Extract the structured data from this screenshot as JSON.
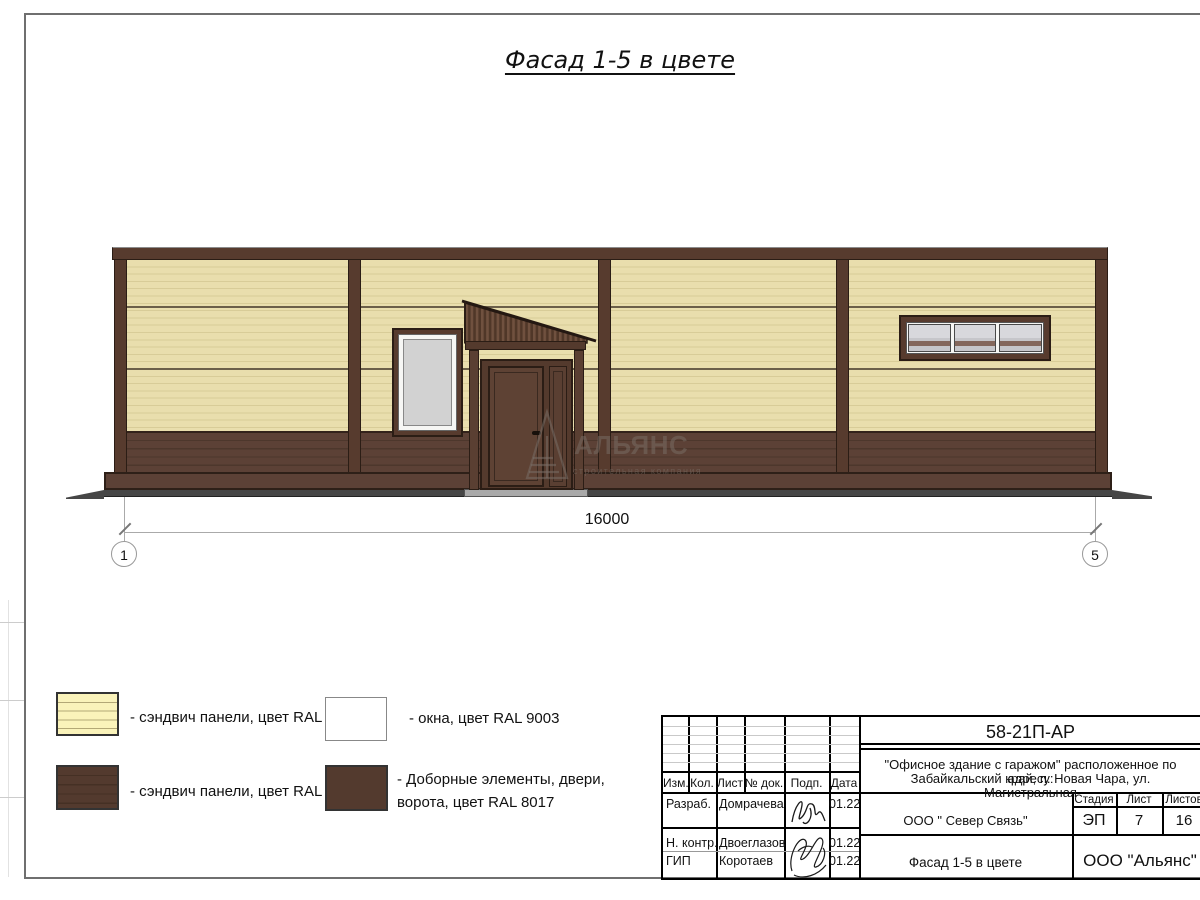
{
  "sheet": {
    "title": "Фасад 1-5 в цвете"
  },
  "dimension": {
    "total": "16000",
    "axis_start": "1",
    "axis_end": "5"
  },
  "watermark": {
    "name": "АЛЬЯНС",
    "tagline": "строительная компания"
  },
  "legend": {
    "sandwich_1014": "- сэндвич панели, цвет RAL 1014",
    "sandwich_8017": "- сэндвич панели, цвет RAL 8017",
    "windows_9003": "- окна, цвет RAL 9003",
    "doors_8017": "- Доборные элементы, двери,\nворота, цвет RAL 8017"
  },
  "title_block": {
    "doc_number": "58-21П-АР",
    "project_line1": "\"Офисное здание с гаражом\" расположенное по адресу:",
    "project_line2": "Забайкальский край, п. Новая Чара, ул. Магистральная",
    "col_izm": "Изм.",
    "col_kol": "Кол.",
    "col_list": "Лист",
    "col_doc": "№ док.",
    "col_podp": "Подп.",
    "col_data": "Дата",
    "rows": [
      {
        "role": "Разраб.",
        "name": "Домрачева",
        "date": "01.22"
      },
      {
        "role": "Н. контр.",
        "name": "Двоеглазов",
        "date": "01.22"
      },
      {
        "role": "ГИП",
        "name": "Коротаев",
        "date": "01.22"
      }
    ],
    "org": "ООО \" Север Связь\"",
    "stage_label": "Стадия",
    "sheet_label": "Лист",
    "sheets_label": "Листов",
    "stage": "ЭП",
    "sheet_num": "7",
    "sheets_total": "16",
    "drawing_name": "Фасад 1-5 в цвете",
    "company": "ООО \"Альянс\""
  },
  "colors": {
    "ral1014_panel": "#e9dead",
    "ral1014_stripe": "#d8cc98",
    "ral8017_panel": "#5c4136",
    "ral8017_trim": "#573b2e",
    "ral8017_dark": "#2b1d15",
    "ral9003_window": "#f6f6f4",
    "glass_gray": "#d2d2d2",
    "ground_gray": "#464646",
    "dim_gray": "#999999"
  }
}
